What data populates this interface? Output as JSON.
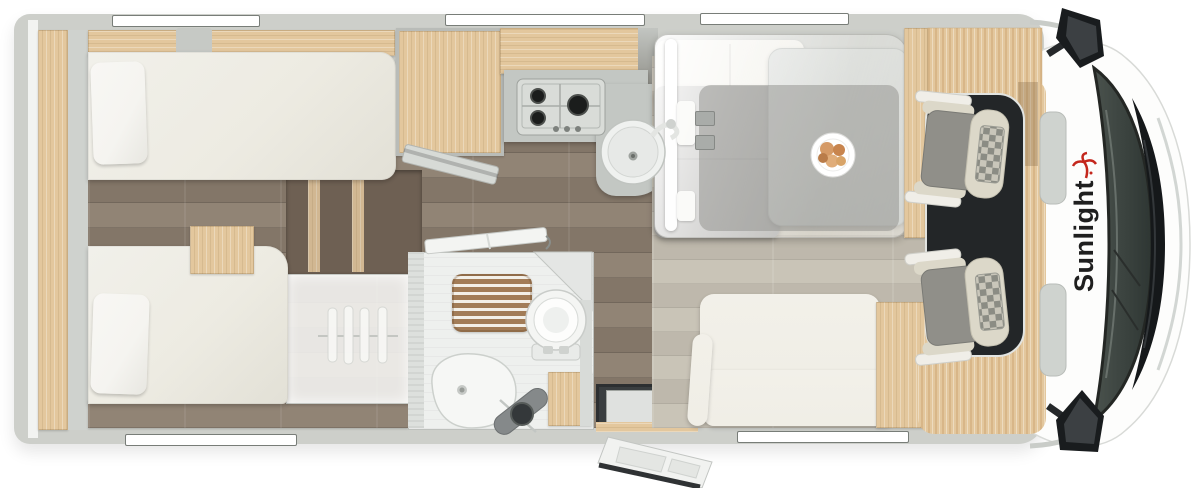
{
  "front": {
    "logo_text": "Sunlight",
    "logo_icon": "palm-tree-icon"
  },
  "colors": {
    "shell": "#cdcfca",
    "wall": "#c6c9c5",
    "window_frame": "#787d78",
    "wood": "#e3c79d",
    "wood_shade": "#caa36f",
    "steps_bg": "#6e6053",
    "floor_dark": "#8b7d6e",
    "floor_lounge": "#c6c0b3",
    "cab_floor": "#232628",
    "mattress": "#edebe2",
    "pillow": "#f5f4f0",
    "cushion_gray": "#a3a29f",
    "bench": "#f0eee6",
    "table": "#cdd0cc",
    "counter": "#c3c7c3",
    "steel": "#d9dcd8",
    "burner": "#1b1d1c",
    "fixture": "#f4f5f3",
    "fixture_line": "#c9ccc9",
    "shower_wood": "#a27c57",
    "seat_cream": "#dcd8c9",
    "seat_gray": "#908f89",
    "checker_a": "#c9c6ba",
    "checker_b": "#8b8c84",
    "glass": "#4a524d",
    "glass_deep": "#2e3633",
    "hood": "#15181a",
    "chrome": "#d2d6d3",
    "logo": "#1f1f1f",
    "palm": "#c4271d",
    "step_well": "#3a3e40"
  }
}
